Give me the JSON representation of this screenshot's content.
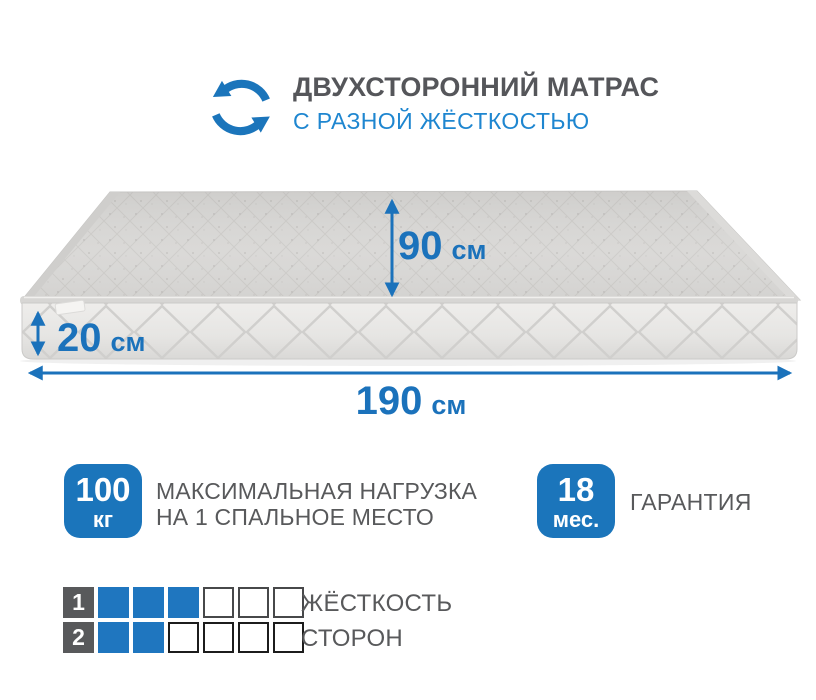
{
  "colors": {
    "accent_blue": "#1b75bb",
    "subtitle_blue": "#1e86d0",
    "text_gray": "#58595b",
    "mattress_gray": "#dad8d6"
  },
  "header": {
    "icon": "flip-arrows-icon",
    "title": "ДВУХСТОРОННИЙ МАТРАС",
    "subtitle": "С РАЗНОЙ ЖЁСТКОСТЬЮ"
  },
  "mattress": {
    "depth": {
      "value": "90",
      "unit": "см"
    },
    "height": {
      "value": "20",
      "unit": "см"
    },
    "length": {
      "value": "190",
      "unit": "см"
    }
  },
  "badges": {
    "max_load": {
      "value": "100",
      "unit": "кг",
      "label_line1": "МАКСИМАЛЬНАЯ НАГРУЗКА",
      "label_line2": "НА 1 СПАЛЬНОЕ МЕСТО"
    },
    "warranty": {
      "value": "18",
      "unit": "мес.",
      "label": "ГАРАНТИЯ"
    }
  },
  "firmness": {
    "label_line1": "ЖЁСТКОСТЬ",
    "label_line2": "СТОРОН",
    "rows": [
      {
        "side": "1",
        "filled": 3,
        "total": 6
      },
      {
        "side": "2",
        "filled": 2,
        "total": 6
      }
    ]
  }
}
